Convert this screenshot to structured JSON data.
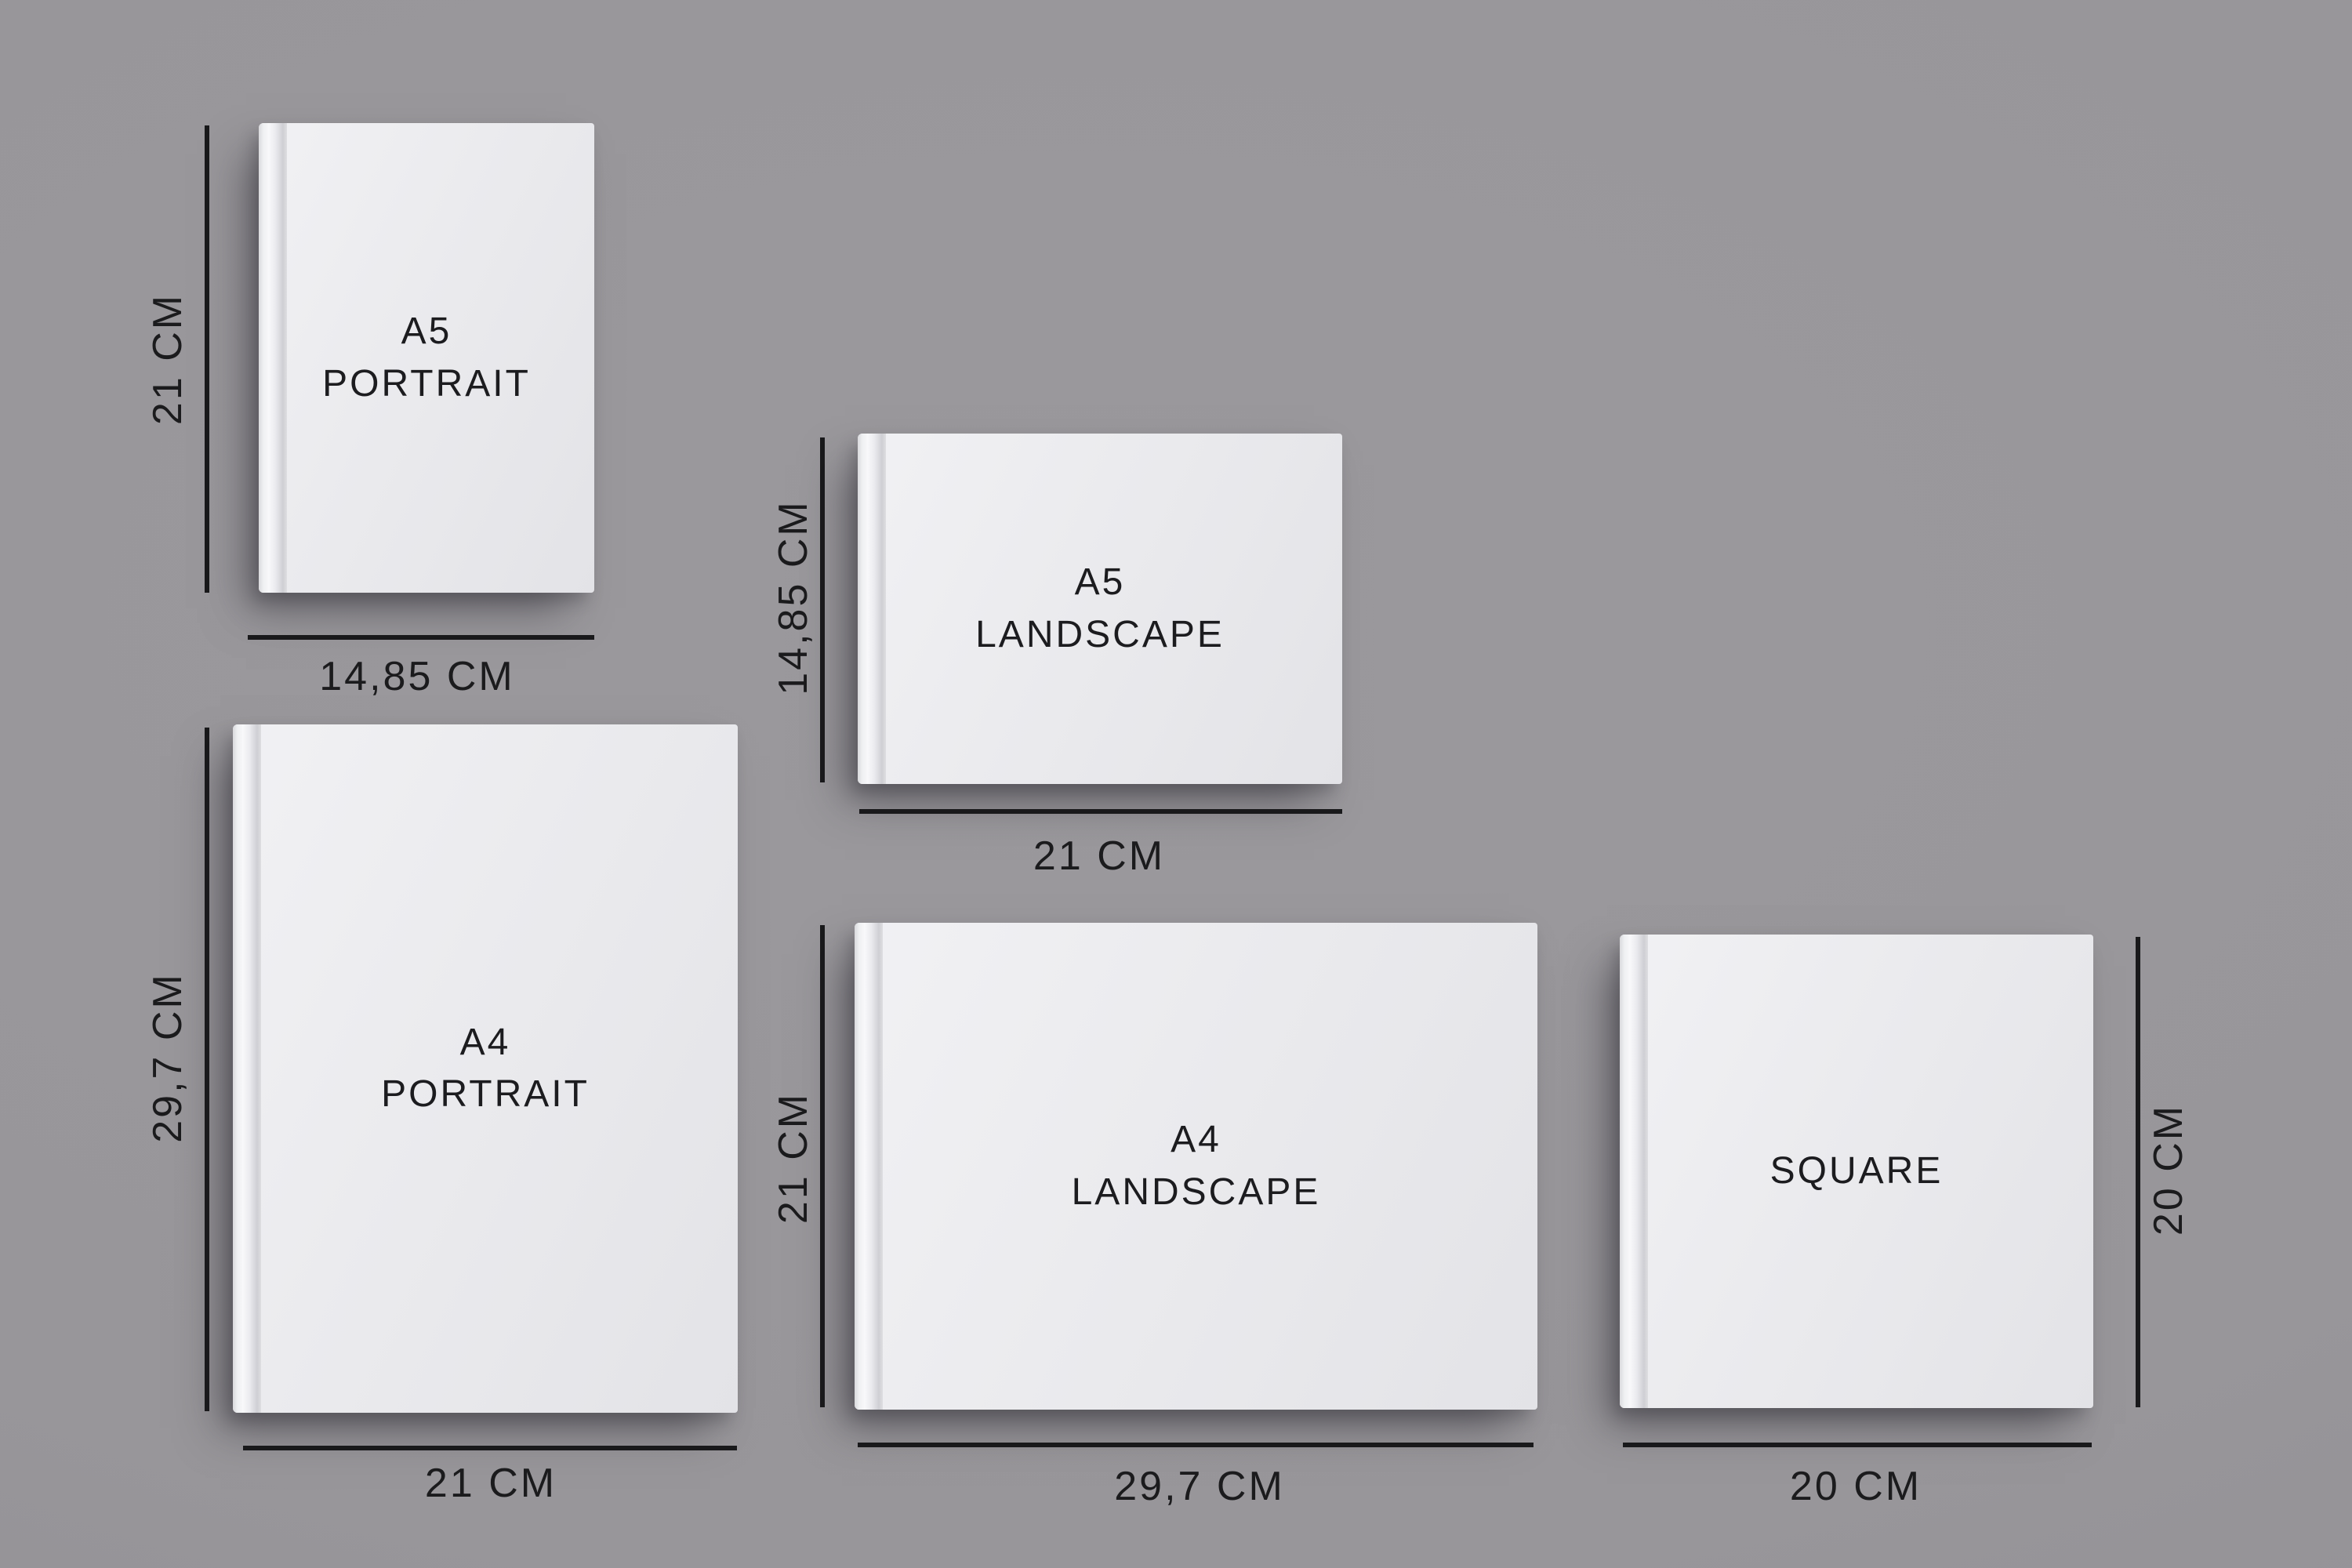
{
  "figure_title": "Photobook size comparison",
  "colors": {
    "background": "#98969a",
    "book_cover": "#eaeaed",
    "spine_highlight": "#f8f8fa",
    "dimension_line": "#19191b",
    "text": "#1b1b1d"
  },
  "books": [
    {
      "id": "a5-portrait",
      "label": "A5\nPORTRAIT",
      "height_label": "21 CM",
      "width_label": "14,85 CM"
    },
    {
      "id": "a5-landscape",
      "label": "A5\nLANDSCAPE",
      "height_label": "14,85 CM",
      "width_label": "21 CM"
    },
    {
      "id": "a4-portrait",
      "label": "A4\nPORTRAIT",
      "height_label": "29,7 CM",
      "width_label": "21 CM"
    },
    {
      "id": "a4-landscape",
      "label": "A4\nLANDSCAPE",
      "height_label": "21 CM",
      "width_label": "29,7 CM"
    },
    {
      "id": "square",
      "label": "SQUARE",
      "height_label": "20 CM",
      "width_label": "20 CM"
    }
  ]
}
